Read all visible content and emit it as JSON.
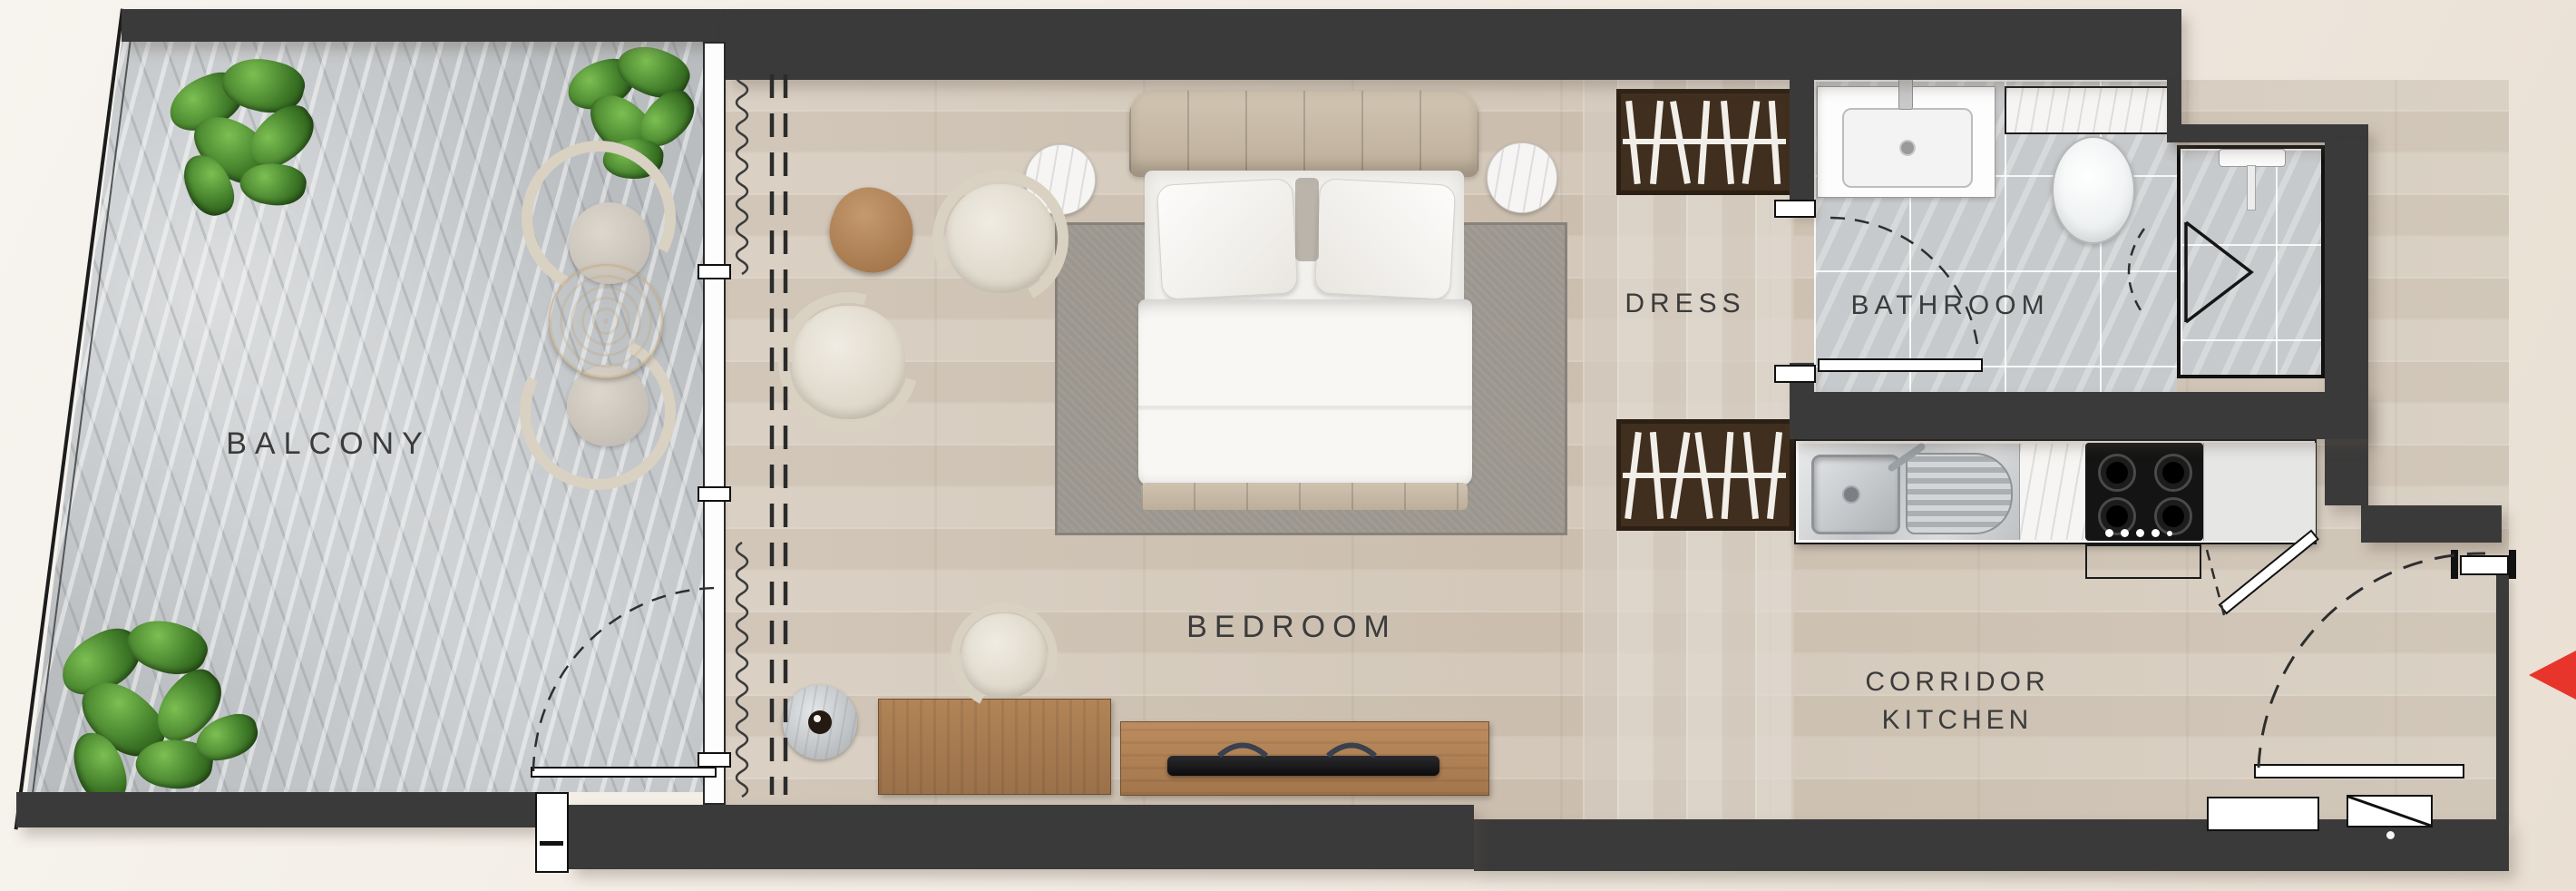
{
  "rooms": {
    "balcony": {
      "label": "BALCONY"
    },
    "bedroom": {
      "label": "BEDROOM"
    },
    "dress": {
      "label": "DRESS"
    },
    "bathroom": {
      "label": "BATHROOM"
    },
    "corridor_kitchen": {
      "label_line1": "CORRIDOR",
      "label_line2": "KITCHEN"
    }
  },
  "colors": {
    "wall": "#3a3a3a",
    "wood_floor": "#d6ccbf",
    "balcony_floor": "#b9bdc0",
    "tile_floor": "#c7cacc",
    "wardrobe_wood": "#3c2b1c",
    "rug": "#9b968e",
    "entrance_arrow": "#e8352b",
    "label_text": "#3b3b3b"
  },
  "icons": {
    "entrance_arrow": "left-pointing-triangle",
    "plants": "potted-plant-top-view",
    "bed": "double-bed-top-view",
    "sofa_chairs": "armchair-top-view",
    "kitchen_sink": "double-basin-sink",
    "hob": "4-burner-gas-hob",
    "toilet": "toilet-top-view",
    "shower": "corner-shower-fan-door",
    "wardrobe": "open-wardrobe-hangers"
  }
}
